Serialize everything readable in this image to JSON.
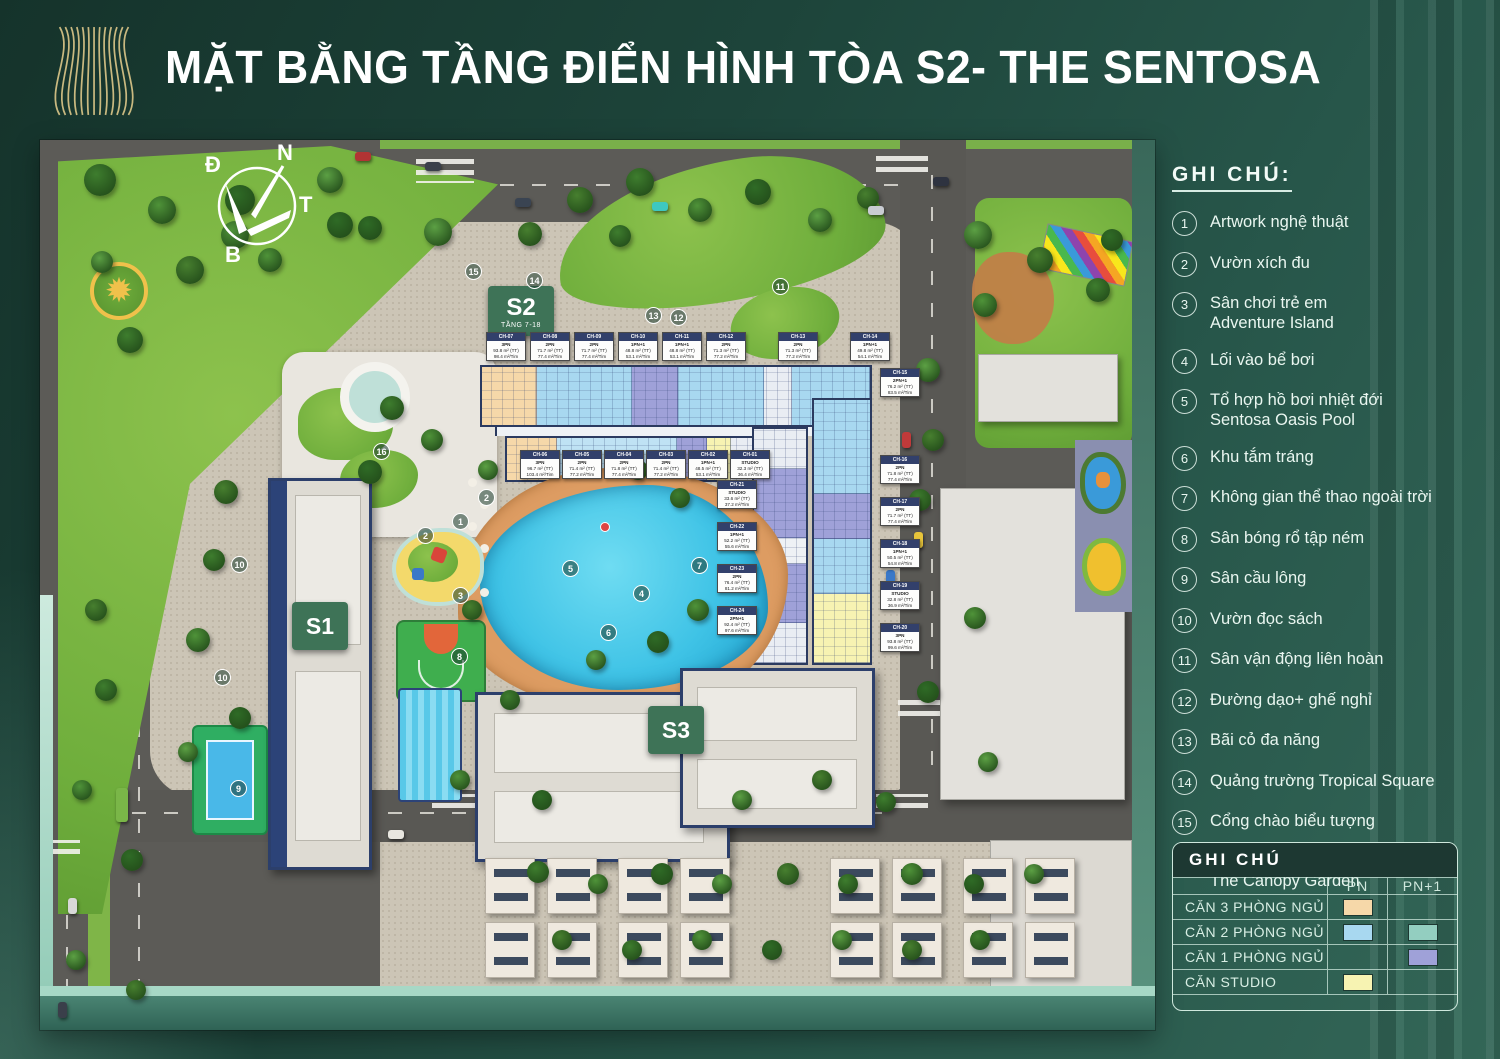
{
  "title": "MẶT BẰNG TẦNG ĐIỂN HÌNH TÒA S2- THE SENTOSA",
  "colors": {
    "background": "#1d443a",
    "title_text": "#ffffff",
    "logo_gold": "#d9c488",
    "unit_3pn": "#f6d8a9",
    "unit_2pn": "#a8d8f0",
    "unit_2pn_plus1": "#93cec0",
    "unit_1pn_plus1": "#9fa1d8",
    "unit_studio": "#f7f3b2",
    "pool_blue": "#3fc3e6",
    "badge_green": "#3e7357"
  },
  "compass": {
    "top": "N",
    "left": "Đ",
    "right": "T",
    "bottom": "B"
  },
  "map": {
    "badges": [
      {
        "id": "s1",
        "label": "S1",
        "sub": ""
      },
      {
        "id": "s2",
        "label": "S2",
        "sub": "TẦNG 7-18"
      },
      {
        "id": "s3",
        "label": "S3",
        "sub": ""
      }
    ],
    "markers": [
      {
        "num": "1",
        "x": 412,
        "y": 373
      },
      {
        "num": "2",
        "x": 438,
        "y": 349
      },
      {
        "num": "2",
        "x": 377,
        "y": 387
      },
      {
        "num": "3",
        "x": 412,
        "y": 447
      },
      {
        "num": "4",
        "x": 593,
        "y": 445
      },
      {
        "num": "5",
        "x": 522,
        "y": 420
      },
      {
        "num": "6",
        "x": 560,
        "y": 484
      },
      {
        "num": "7",
        "x": 651,
        "y": 417
      },
      {
        "num": "8",
        "x": 411,
        "y": 508
      },
      {
        "num": "9",
        "x": 190,
        "y": 640
      },
      {
        "num": "10",
        "x": 191,
        "y": 416
      },
      {
        "num": "10",
        "x": 174,
        "y": 529
      },
      {
        "num": "11",
        "x": 732,
        "y": 138
      },
      {
        "num": "12",
        "x": 630,
        "y": 169
      },
      {
        "num": "13",
        "x": 605,
        "y": 167
      },
      {
        "num": "14",
        "x": 486,
        "y": 132
      },
      {
        "num": "15",
        "x": 425,
        "y": 123
      },
      {
        "num": "16",
        "x": 333,
        "y": 303
      }
    ],
    "unit_cards": {
      "top_row": [
        {
          "id": "CH-07",
          "type": "3PN",
          "a1": "93.8 m² (TT)",
          "a2": "98.4 m²/Tim"
        },
        {
          "id": "CH-08",
          "type": "2PN",
          "a1": "71.7 m² (TT)",
          "a2": "77.4 m²/Tim"
        },
        {
          "id": "CH-09",
          "type": "2PN",
          "a1": "71.7 m² (TT)",
          "a2": "77.4 m²/Tim"
        },
        {
          "id": "CH-10",
          "type": "1PN+1",
          "a1": "48.8 m² (TT)",
          "a2": "53.1 m²/Tim"
        },
        {
          "id": "CH-11",
          "type": "1PN+1",
          "a1": "48.8 m² (TT)",
          "a2": "53.1 m²/Tim"
        },
        {
          "id": "CH-12",
          "type": "2PN",
          "a1": "71.3 m² (TT)",
          "a2": "77.2 m²/Tim"
        },
        {
          "id": "CH-13",
          "type": "2PN",
          "a1": "71.3 m² (TT)",
          "a2": "77.2 m²/Tim"
        },
        {
          "id": "CH-14",
          "type": "1PN+1",
          "a1": "49.8 m² (TT)",
          "a2": "54.1 m²/Tim"
        }
      ],
      "middle_row": [
        {
          "id": "CH-06",
          "type": "3PN",
          "a1": "96.7 m² (TT)",
          "a2": "103.4 m²/Tim"
        },
        {
          "id": "CH-05",
          "type": "2PN",
          "a1": "71.4 m² (TT)",
          "a2": "77.2 m²/Tim"
        },
        {
          "id": "CH-04",
          "type": "2PN",
          "a1": "71.8 m² (TT)",
          "a2": "77.4 m²/Tim"
        },
        {
          "id": "CH-03",
          "type": "2PN",
          "a1": "71.4 m² (TT)",
          "a2": "77.2 m²/Tim"
        },
        {
          "id": "CH-02",
          "type": "1PN+1",
          "a1": "48.5 m² (TT)",
          "a2": "53.1 m²/Tim"
        },
        {
          "id": "CH-01",
          "type": "STUDIO",
          "a1": "32.3 m² (TT)",
          "a2": "36.4 m²/Tim"
        }
      ],
      "right_inner_col": [
        {
          "id": "CH-21",
          "type": "STUDIO",
          "a1": "33.6 m² (TT)",
          "a2": "37.2 m²/Tim"
        },
        {
          "id": "CH-22",
          "type": "1PN+1",
          "a1": "52.2 m² (TT)",
          "a2": "55.6 m²/Tim"
        },
        {
          "id": "CH-23",
          "type": "2PN",
          "a1": "76.4 m² (TT)",
          "a2": "81.2 m²/Tim"
        },
        {
          "id": "CH-24",
          "type": "2PN+1",
          "a1": "92.4 m² (TT)",
          "a2": "97.6 m²/Tim"
        }
      ],
      "right_outer_col": [
        {
          "id": "CH-15",
          "type": "2PN+1",
          "a1": "76.2 m² (TT)",
          "a2": "83.5 m²/Tim"
        },
        {
          "id": "CH-16",
          "type": "2PN",
          "a1": "71.8 m² (TT)",
          "a2": "77.4 m²/Tim"
        },
        {
          "id": "CH-17",
          "type": "2PN",
          "a1": "71.7 m² (TT)",
          "a2": "77.4 m²/Tim"
        },
        {
          "id": "CH-18",
          "type": "1PN+1",
          "a1": "50.5 m² (TT)",
          "a2": "54.8 m²/Tim"
        },
        {
          "id": "CH-19",
          "type": "STUDIO",
          "a1": "32.8 m² (TT)",
          "a2": "36.9 m²/Tim"
        },
        {
          "id": "CH-20",
          "type": "3PN",
          "a1": "93.8 m² (TT)",
          "a2": "99.6 m²/Tim"
        }
      ]
    }
  },
  "legend": {
    "heading": "GHI CHÚ:",
    "items": [
      {
        "num": "1",
        "label": "Artwork nghệ thuật"
      },
      {
        "num": "2",
        "label": "Vườn xích đu"
      },
      {
        "num": "3",
        "label": "Sân chơi trẻ em",
        "label2": "Adventure Island"
      },
      {
        "num": "4",
        "label": "Lối vào bể bơi"
      },
      {
        "num": "5",
        "label": "Tổ hợp hồ bơi nhiệt đới",
        "label2": "Sentosa Oasis Pool"
      },
      {
        "num": "6",
        "label": "Khu tắm tráng"
      },
      {
        "num": "7",
        "label": "Không gian thể thao ngoài trời"
      },
      {
        "num": "8",
        "label": "Sân bóng rổ tập ném"
      },
      {
        "num": "9",
        "label": "Sân cầu lông"
      },
      {
        "num": "10",
        "label": "Vườn đọc sách"
      },
      {
        "num": "11",
        "label": "Sân vận động liên hoàn"
      },
      {
        "num": "12",
        "label": "Đường dạo+ ghế nghỉ"
      },
      {
        "num": "13",
        "label": "Bãi cỏ đa năng"
      },
      {
        "num": "14",
        "label": "Quảng trường Tropical Square"
      },
      {
        "num": "15",
        "label": "Cổng chào biểu tượng"
      },
      {
        "num": "16",
        "label": "Công viên vườn trên mây",
        "label2": "The Canopy Garden"
      }
    ]
  },
  "unit_table": {
    "title": "GHI CHÚ",
    "col_pn": "PN",
    "col_pn1": "PN+1",
    "rows": [
      {
        "label": "CĂN 3 PHÒNG NGỦ",
        "pn": "#f6d8a9",
        "pn1": null
      },
      {
        "label": "CĂN 2 PHÒNG NGỦ",
        "pn": "#a8d8f0",
        "pn1": "#93cec0"
      },
      {
        "label": "CĂN 1 PHÒNG NGỦ",
        "pn": null,
        "pn1": "#9fa1d8"
      },
      {
        "label": "CĂN STUDIO",
        "pn": "#f7f3b2",
        "pn1": null
      }
    ]
  }
}
